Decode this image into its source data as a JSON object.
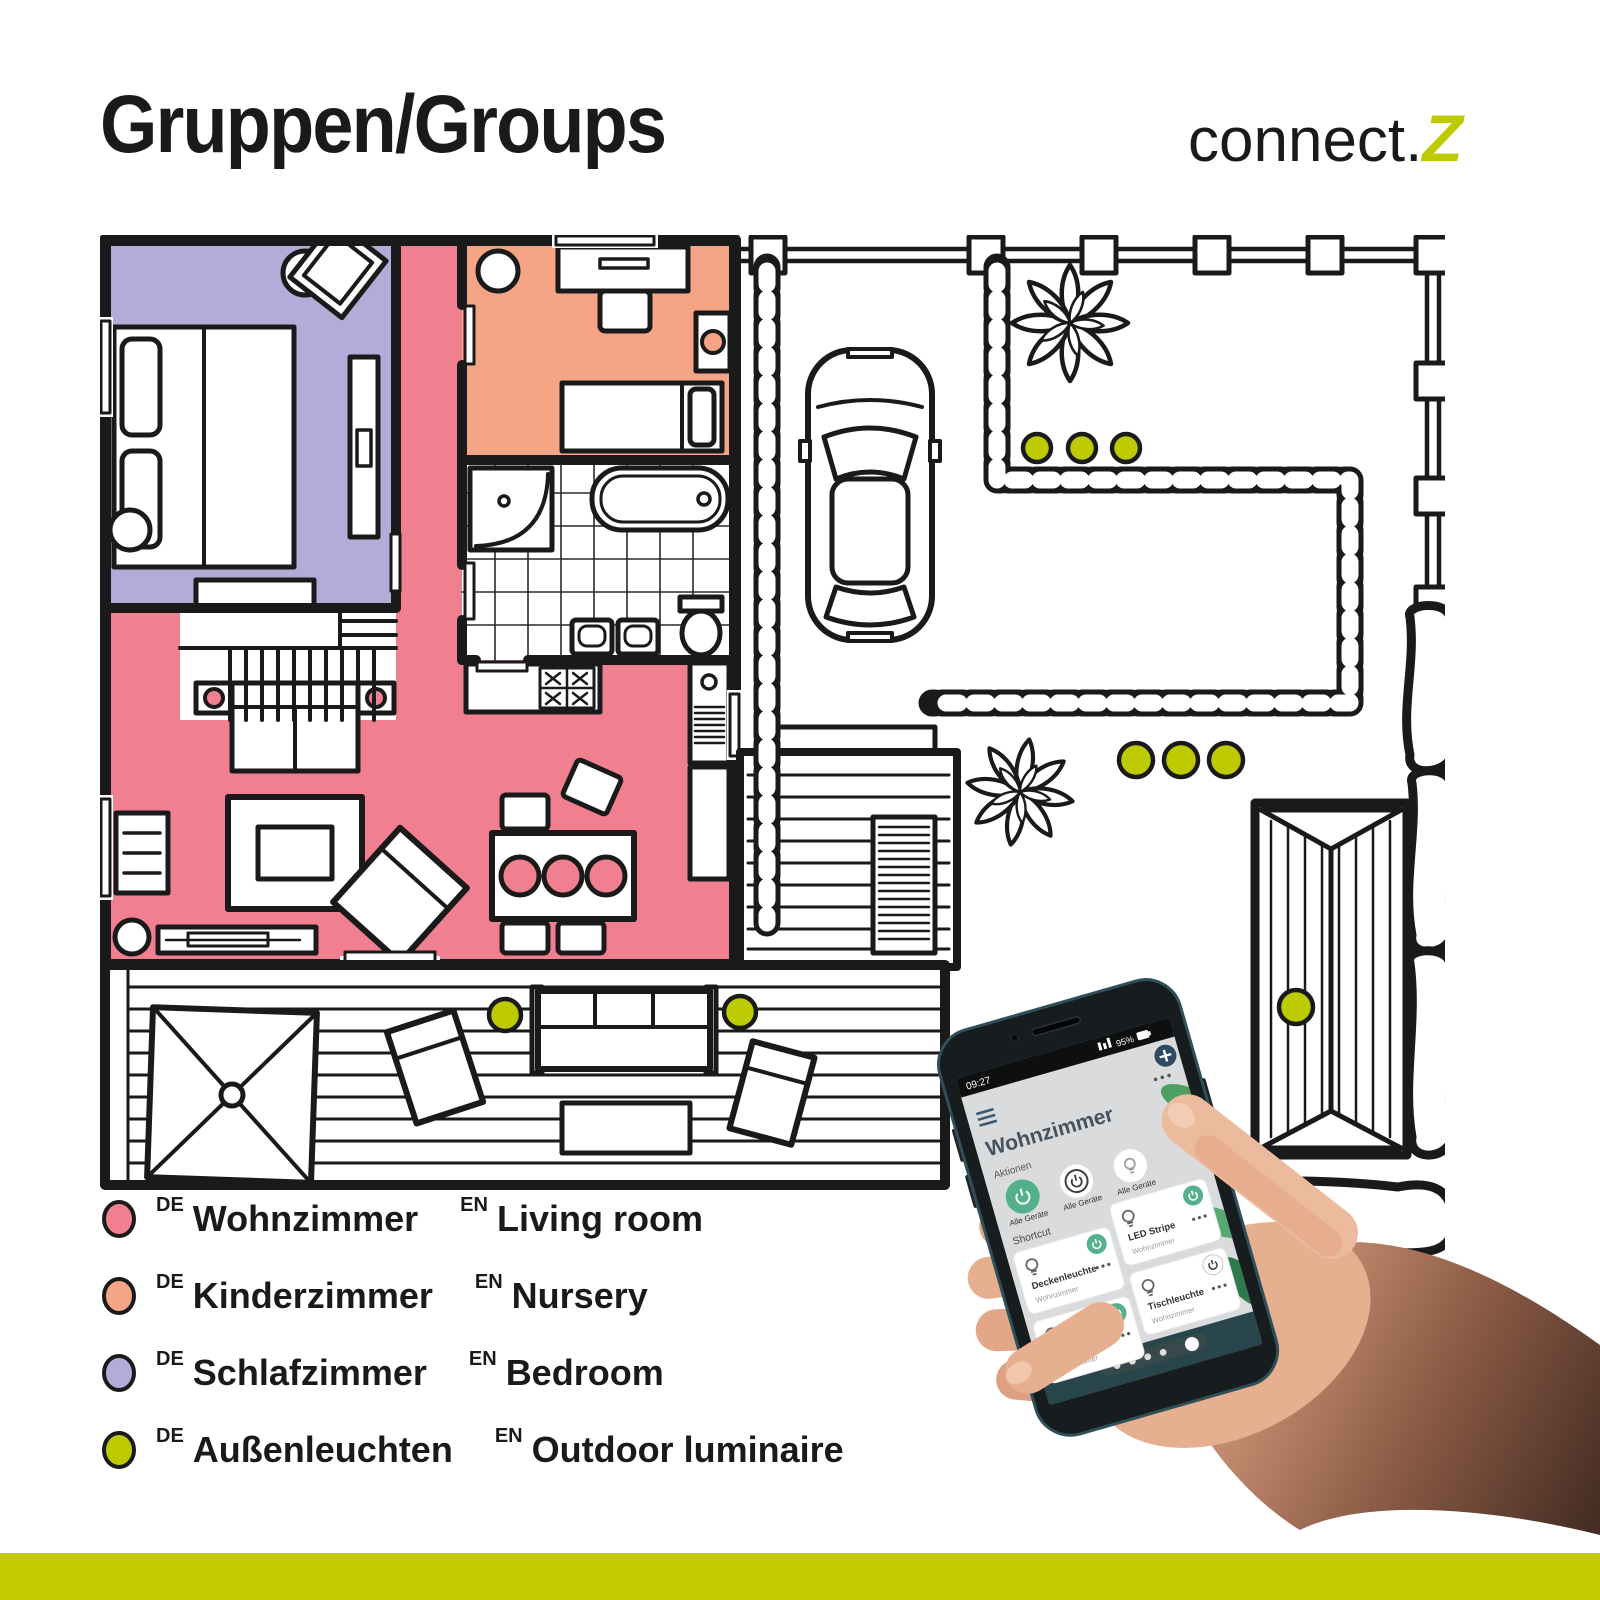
{
  "header": {
    "title": "Gruppen/Groups",
    "brand_name": "connect.",
    "brand_z": "Z"
  },
  "legend": {
    "items": [
      {
        "de_tag": "DE",
        "de": "Wohnzimmer",
        "en_tag": "EN",
        "en": "Living room",
        "color": "#F0808F"
      },
      {
        "de_tag": "DE",
        "de": "Kinderzimmer",
        "en_tag": "EN",
        "en": "Nursery",
        "color": "#F5A486"
      },
      {
        "de_tag": "DE",
        "de": "Schlafzimmer",
        "en_tag": "EN",
        "en": "Bedroom",
        "color": "#B5ABD8"
      },
      {
        "de_tag": "DE",
        "de": "Außenleuchten",
        "en_tag": "EN",
        "en": "Outdoor luminaire",
        "color": "#BDCA00"
      }
    ]
  },
  "floor_plan": {
    "rooms": [
      {
        "name": "Wohnzimmer",
        "color": "#F0808F"
      },
      {
        "name": "Kinderzimmer",
        "color": "#F5A486"
      },
      {
        "name": "Schlafzimmer",
        "color": "#B5ABD8"
      }
    ],
    "outdoor_light_color": "#BDCA00",
    "outdoor_lights": {
      "deck": 2,
      "garden_upper_row": 3,
      "garden_lower_row": 3,
      "garden_door": 1
    }
  },
  "phone": {
    "status": {
      "time": "09:27",
      "battery": "95%"
    },
    "title": "Wohnzimmer",
    "actions_label": "Aktionen",
    "shortcut_label": "Shortcut",
    "actions": [
      {
        "label": "Alle Geräte"
      },
      {
        "label": "Alle Geräte"
      },
      {
        "label": "Alle Geräte"
      }
    ],
    "tiles": [
      {
        "name": "Deckenleuchte",
        "room": "Wohnzimmer"
      },
      {
        "name": "LED Stripe",
        "room": "Wohnzimmer"
      },
      {
        "name": "Stehleuchte",
        "room": "Wohnzimmer"
      },
      {
        "name": "Tischleuchte",
        "room": "Wohnzimmer"
      }
    ]
  },
  "colors": {
    "accent_lime": "#C3CC00",
    "line_black": "#1A1A1A",
    "app_green": "#53B08D",
    "app_blue": "#2C4A63"
  }
}
